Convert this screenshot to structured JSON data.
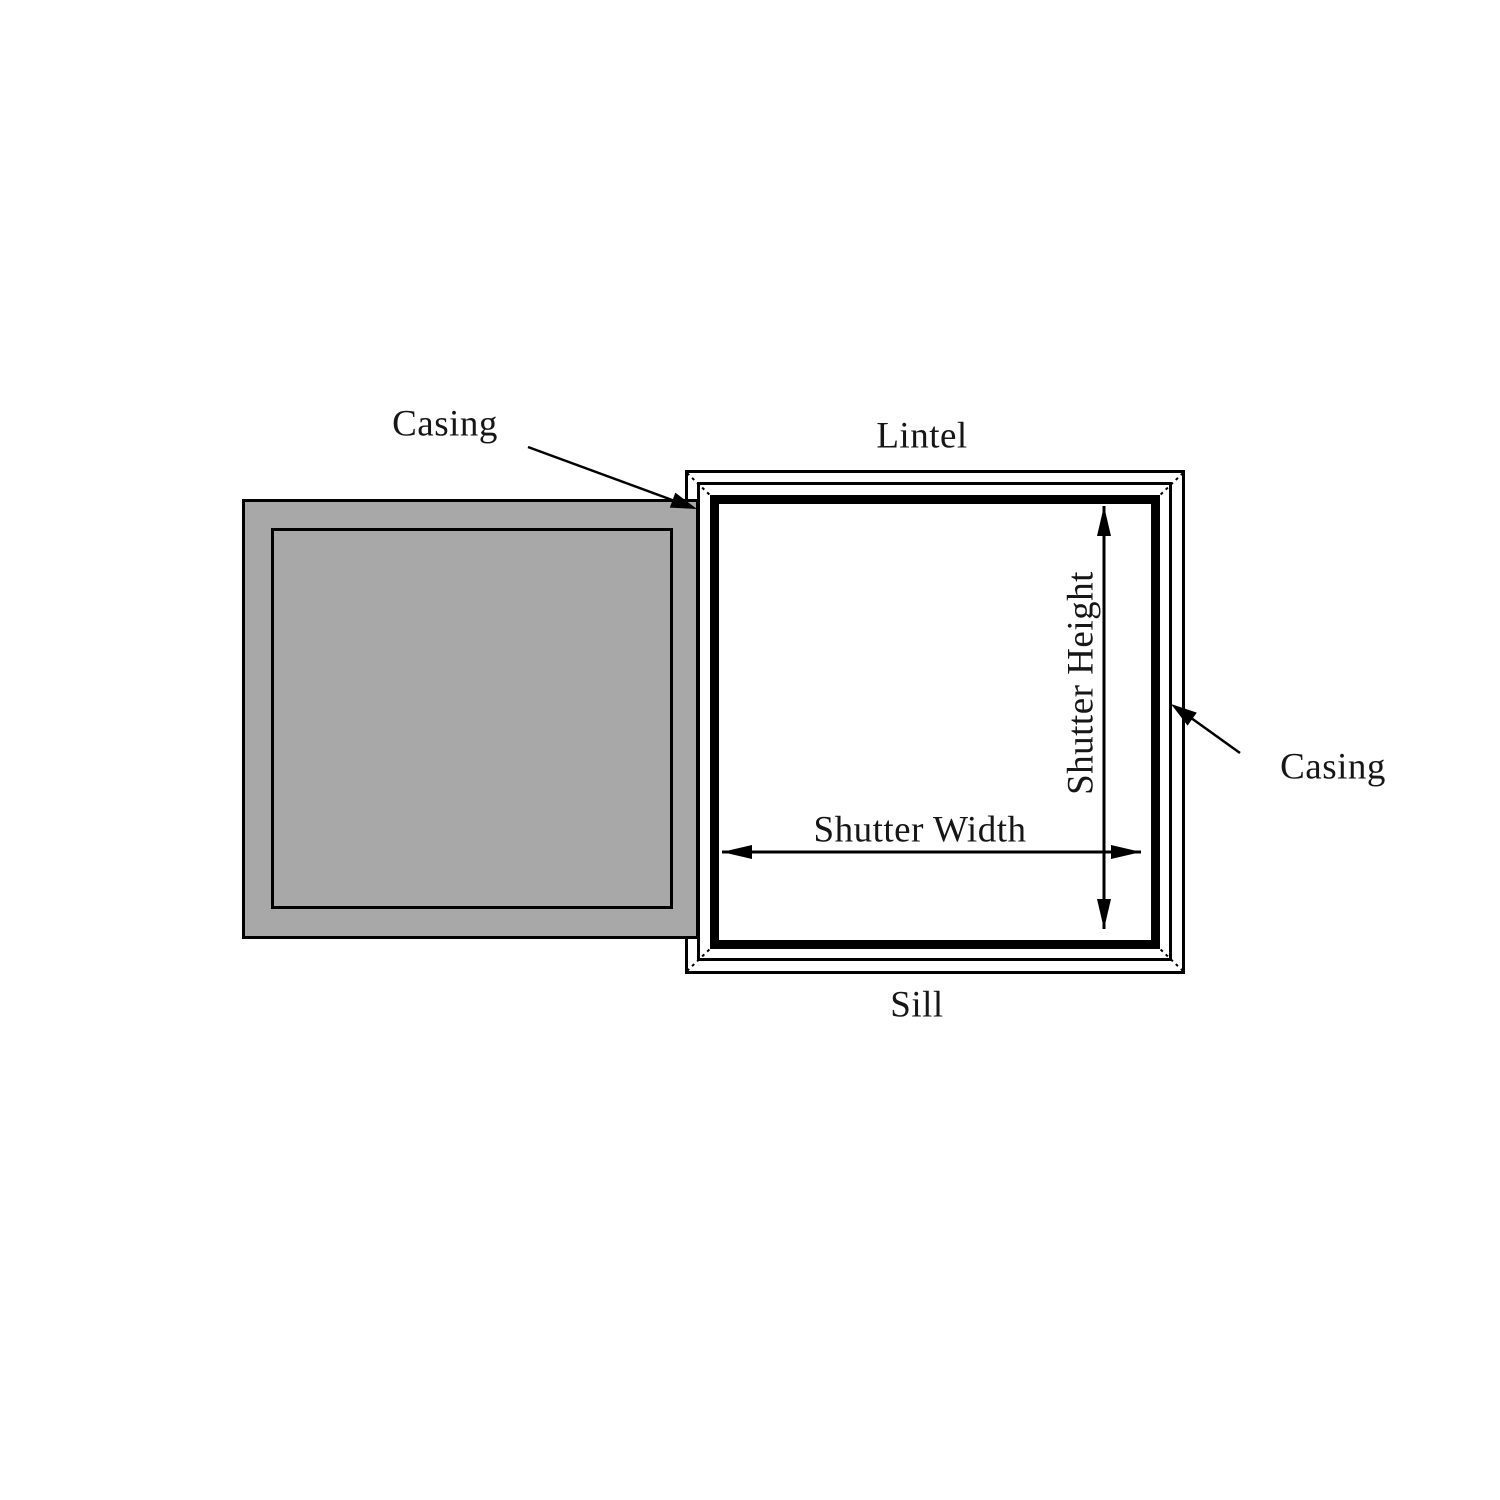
{
  "diagram": {
    "type": "window-shutter-measurement-diagram",
    "labels": {
      "casing_left": "Casing",
      "casing_right": "Casing",
      "lintel": "Lintel",
      "sill": "Sill",
      "shutter_width": "Shutter Width",
      "shutter_height": "Shutter Height"
    },
    "colors": {
      "line": "#000000",
      "text": "#161616",
      "shutter_fill": "#a8a8a8",
      "background": "#ffffff"
    }
  }
}
